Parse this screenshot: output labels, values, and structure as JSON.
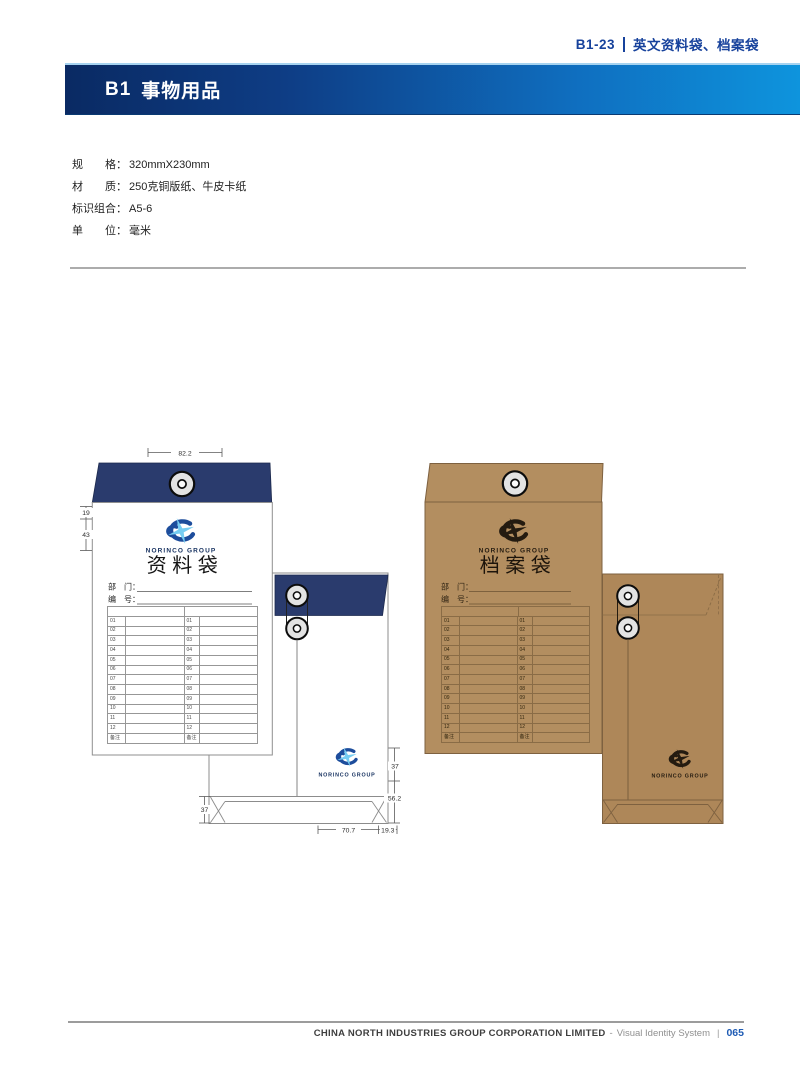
{
  "page_ref": {
    "code": "B1-23",
    "title": "英文资料袋、档案袋"
  },
  "section_header": {
    "code": "B1",
    "title": "事物用品"
  },
  "specs": {
    "rows": [
      {
        "label": "规　　格：",
        "value": "320mmX230mm"
      },
      {
        "label": "材　　质：",
        "value": "250克铜版纸、牛皮卡纸"
      },
      {
        "label": "标识组合：",
        "value": "A5-6"
      },
      {
        "label": "单　　位：",
        "value": "毫米"
      }
    ]
  },
  "envelopes": {
    "data_bag": {
      "title": "资料袋",
      "brand": "NORINCO GROUP",
      "dept_label": "部　门：",
      "no_label": "编　号："
    },
    "archive_bag": {
      "title": "档案袋",
      "brand": "NORINCO GROUP",
      "dept_label": "部　门：",
      "no_label": "编　号："
    }
  },
  "index_table": {
    "rows": [
      "01",
      "02",
      "03",
      "04",
      "05",
      "06",
      "07",
      "08",
      "09",
      "10",
      "11",
      "12",
      "备注"
    ]
  },
  "dimensions": {
    "flap_width": "82.2",
    "flap_depth": "19",
    "logo_offset": "43",
    "back_logo_offset": "37",
    "back_bottom_zone": "56.2",
    "gusset_height": "37",
    "bottom_width": "70.7",
    "bottom_flap": "19.3"
  },
  "colors": {
    "accent_blue": "#17429c",
    "navy_flap": "#2a3b6d",
    "kraft_front": "#b38e60",
    "kraft_back": "#ae8759",
    "logo_blue": "#1d4d9c",
    "logo_star": "#76cdf2"
  },
  "footer": {
    "company": "CHINA NORTH INDUSTRIES GROUP CORPORATION LIMITED",
    "dash": "-",
    "system_name": "Visual Identity System",
    "bar": "|",
    "page_number": "065"
  }
}
